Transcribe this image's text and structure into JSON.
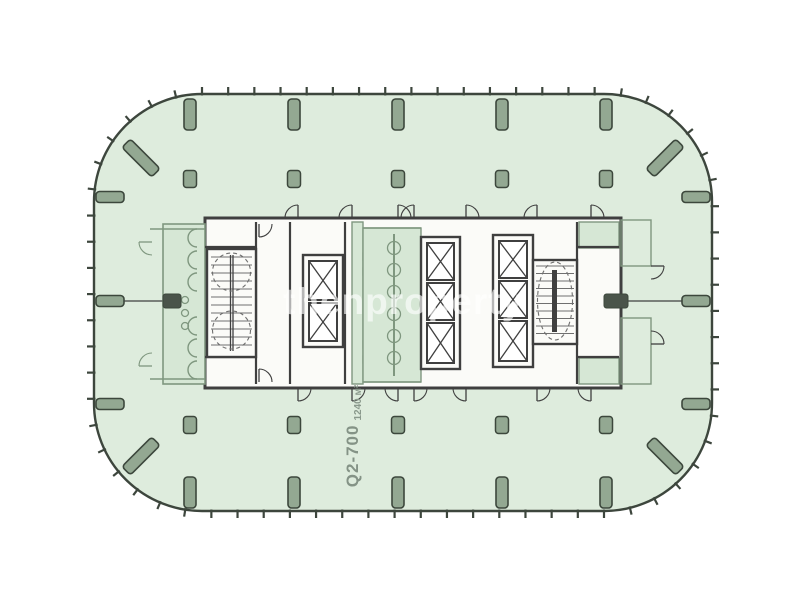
{
  "watermark": {
    "text": "thenproperty"
  },
  "unit_label": {
    "unit": "Q2-700",
    "area": "1240 м²"
  },
  "colors": {
    "plate_fill": "#deecdd",
    "line": "#3d463d",
    "column_fill": "#93a892",
    "column_edge": "#3c473c",
    "core_line": "#3f3f3f",
    "room_fill": "#fbfbf8",
    "green_line": "#7f977f",
    "green_fill": "#d6e7d5",
    "axis_block": "#4a544a",
    "stair_detail": "#6f6f6f"
  },
  "plan": {
    "plate": {
      "x": 94,
      "y": 94,
      "w": 618,
      "h": 417,
      "r": 108
    },
    "tick": {
      "spacing": 26,
      "len": 7,
      "width": 2.2
    },
    "grid_x": [
      190,
      294,
      398,
      502,
      606
    ],
    "side_y": [
      197,
      301,
      404
    ],
    "perimeter_bars": {
      "top_y": 99,
      "bottom_y": 477,
      "bar_w": 12,
      "bar_len": 31,
      "left_x": 96,
      "right_x": 682,
      "side_len": 28,
      "side_w": 11
    },
    "corner_bars": [
      {
        "cx": 141,
        "cy": 158,
        "rot": 45
      },
      {
        "cx": 665,
        "cy": 158,
        "rot": -45
      },
      {
        "cx": 141,
        "cy": 456,
        "rot": -45
      },
      {
        "cx": 665,
        "cy": 456,
        "rot": 45
      }
    ],
    "corner_bar_size": {
      "w": 42,
      "h": 12
    },
    "inner_columns": {
      "rows_y": [
        179,
        425
      ],
      "w": 13,
      "h": 17
    },
    "axis": {
      "y": 301,
      "left_seg": [
        97,
        205
      ],
      "right_seg": [
        621,
        710
      ],
      "blocks": [
        [
          163,
          294,
          18,
          14
        ],
        [
          604,
          294,
          24,
          14
        ]
      ]
    },
    "core_outer": [
      205,
      218,
      416,
      170
    ],
    "walls_v": [
      [
        256,
        222,
        384
      ],
      [
        290,
        222,
        384
      ],
      [
        345,
        222,
        384
      ],
      [
        577,
        222,
        384
      ]
    ],
    "walls_h": [
      [
        205,
        247,
        256
      ],
      [
        205,
        357,
        256
      ],
      [
        577,
        247,
        619
      ],
      [
        577,
        357,
        619
      ]
    ],
    "shaft_frames": [
      [
        303,
        255,
        40,
        92
      ],
      [
        421,
        237,
        39,
        132
      ],
      [
        493,
        235,
        40,
        132
      ]
    ],
    "shafts": [
      [
        309,
        261,
        28,
        39
      ],
      [
        309,
        303,
        28,
        38
      ],
      [
        427,
        243,
        27,
        37
      ],
      [
        427,
        283,
        27,
        37
      ],
      [
        427,
        323,
        27,
        40
      ],
      [
        499,
        241,
        28,
        37
      ],
      [
        499,
        281,
        28,
        37
      ],
      [
        499,
        321,
        28,
        40
      ]
    ],
    "stair_a": {
      "frame": [
        207,
        249,
        49,
        108
      ],
      "tread_x": [
        211,
        252
      ],
      "tread_y0": 257,
      "tread_y1": 349,
      "step": 8,
      "rail_x": [
        230.5,
        233
      ],
      "rail_y": [
        255,
        351
      ],
      "dashed_circles": [
        [
          231.5,
          272,
          19
        ],
        [
          231.5,
          330,
          19
        ]
      ]
    },
    "stair_b": {
      "frame": [
        533,
        260,
        44,
        84
      ],
      "tread_x": [
        536,
        574
      ],
      "tread_y0": 266,
      "tread_y1": 336,
      "step": 7.5,
      "rail_rect": [
        552,
        270,
        5,
        62
      ],
      "dashed_ellipse": [
        555,
        301,
        17.5,
        39
      ]
    },
    "left_strip": {
      "rect": [
        163,
        224,
        42,
        160
      ],
      "scallop_x": 197,
      "scallop_y": [
        238,
        260,
        282,
        326,
        348,
        370
      ],
      "scallop_r": 9,
      "fixtures": [
        [
          185,
          300
        ],
        [
          185,
          313
        ],
        [
          185,
          326
        ]
      ]
    },
    "mid_restroom": {
      "rect": [
        363,
        228,
        58,
        154
      ],
      "wall_x": 394,
      "wall_y": [
        234,
        376
      ],
      "scallop_y": [
        248,
        270,
        292,
        314,
        336,
        358
      ],
      "scallop_r": 6.5
    },
    "service_strip": {
      "rect": [
        352,
        222,
        11,
        162
      ],
      "boxes": [
        [
          363,
          253
        ],
        [
          363,
          268
        ],
        [
          363,
          341
        ],
        [
          363,
          356
        ]
      ],
      "box": 7
    },
    "green_hwalls": [
      [
        150,
        229,
        205
      ],
      [
        150,
        379,
        205
      ],
      [
        363,
        228,
        421
      ],
      [
        363,
        382,
        421
      ]
    ],
    "green_rooms": [
      [
        579,
        222,
        40,
        26
      ],
      [
        579,
        358,
        40,
        26
      ]
    ],
    "outside_rooms": [
      [
        621,
        220,
        30,
        46
      ],
      [
        621,
        318,
        30,
        66
      ]
    ],
    "door_r": 13,
    "doors_dark": [
      [
        298,
        218,
        "up",
        1
      ],
      [
        352,
        218,
        "up",
        1
      ],
      [
        398,
        218,
        "up",
        0
      ],
      [
        414,
        218,
        "up",
        1
      ],
      [
        466,
        218,
        "up",
        0
      ],
      [
        537,
        218,
        "up",
        1
      ],
      [
        591,
        218,
        "up",
        0
      ],
      [
        298,
        388,
        "down",
        0
      ],
      [
        352,
        388,
        "down",
        0
      ],
      [
        398,
        388,
        "down",
        1
      ],
      [
        414,
        388,
        "down",
        0
      ],
      [
        466,
        388,
        "down",
        1
      ],
      [
        537,
        388,
        "down",
        0
      ],
      [
        591,
        388,
        "down",
        1
      ],
      [
        259,
        224,
        "down",
        0
      ],
      [
        259,
        382,
        "up",
        0
      ],
      [
        651,
        266,
        "right",
        0
      ],
      [
        651,
        344,
        "right",
        1
      ]
    ],
    "doors_green": [
      [
        152,
        242,
        "left",
        0
      ],
      [
        152,
        366,
        "left",
        1
      ]
    ]
  }
}
